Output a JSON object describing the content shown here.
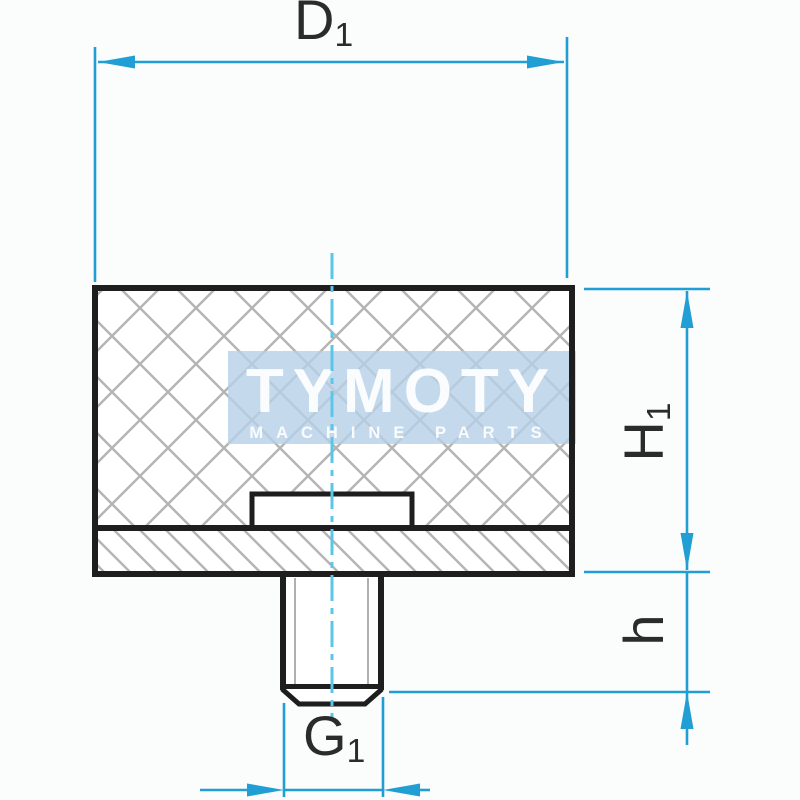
{
  "drawing": {
    "kind": "technical-section-drawing",
    "part": "rubber-metal buffer with threaded stud"
  },
  "watermark": {
    "brand": "TYMOTY",
    "tagline": "MACHINE PARTS"
  },
  "dimensions": {
    "diameter_top": {
      "main": "D",
      "sub": "1"
    },
    "body_height": {
      "main": "H",
      "sub": "1"
    },
    "stud_height": {
      "main": "h",
      "sub": ""
    },
    "thread_bottom": {
      "main": "G",
      "sub": "1"
    }
  },
  "colors": {
    "dimension": "#219ed4",
    "centerline": "#5ac6e8",
    "outline": "#1e1e1e",
    "hatch": "#b4b4b4",
    "watermark_bg": "#b5d1e7",
    "label": "#2b2b2b"
  }
}
